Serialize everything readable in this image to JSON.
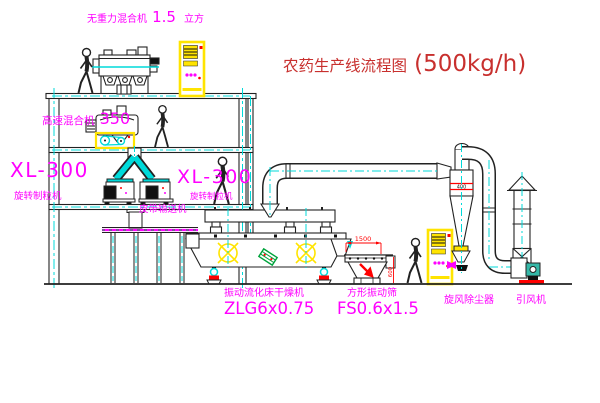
{
  "title": {
    "text": "农药生产线流程图",
    "capacity": "(500kg/h)"
  },
  "labels": {
    "gravity_mixer": {
      "name": "无重力混合机",
      "size": "1.5",
      "unit": "立方"
    },
    "high_speed_mixer": {
      "name": "高速混合机",
      "size": "350"
    },
    "granulator_left": {
      "model": "XL-300",
      "name": "旋转制粒机"
    },
    "granulator_mid": {
      "model": "XL-300",
      "name": "旋转制粒机"
    },
    "belt_conveyor": "皮带输送机",
    "dryer": {
      "name": "振动流化床干燥机",
      "model": "ZLG6x0.75"
    },
    "screen": {
      "name": "方形振动筛",
      "model": "FS0.6x1.5"
    },
    "cyclone": "旋风除尘器",
    "fan": "引风机"
  },
  "dimensions": {
    "screen_length": "1500",
    "screen_height": "600",
    "cyclone_band": "400"
  },
  "colors": {
    "label_magenta": "#ff00ff",
    "title_red": "#c8302e",
    "dimension_red": "#ff0000",
    "centerline_cyan": "#00dada",
    "equipment_yellow": "#ffe400",
    "accent_green": "#00a33c",
    "line_black": "#222222"
  }
}
